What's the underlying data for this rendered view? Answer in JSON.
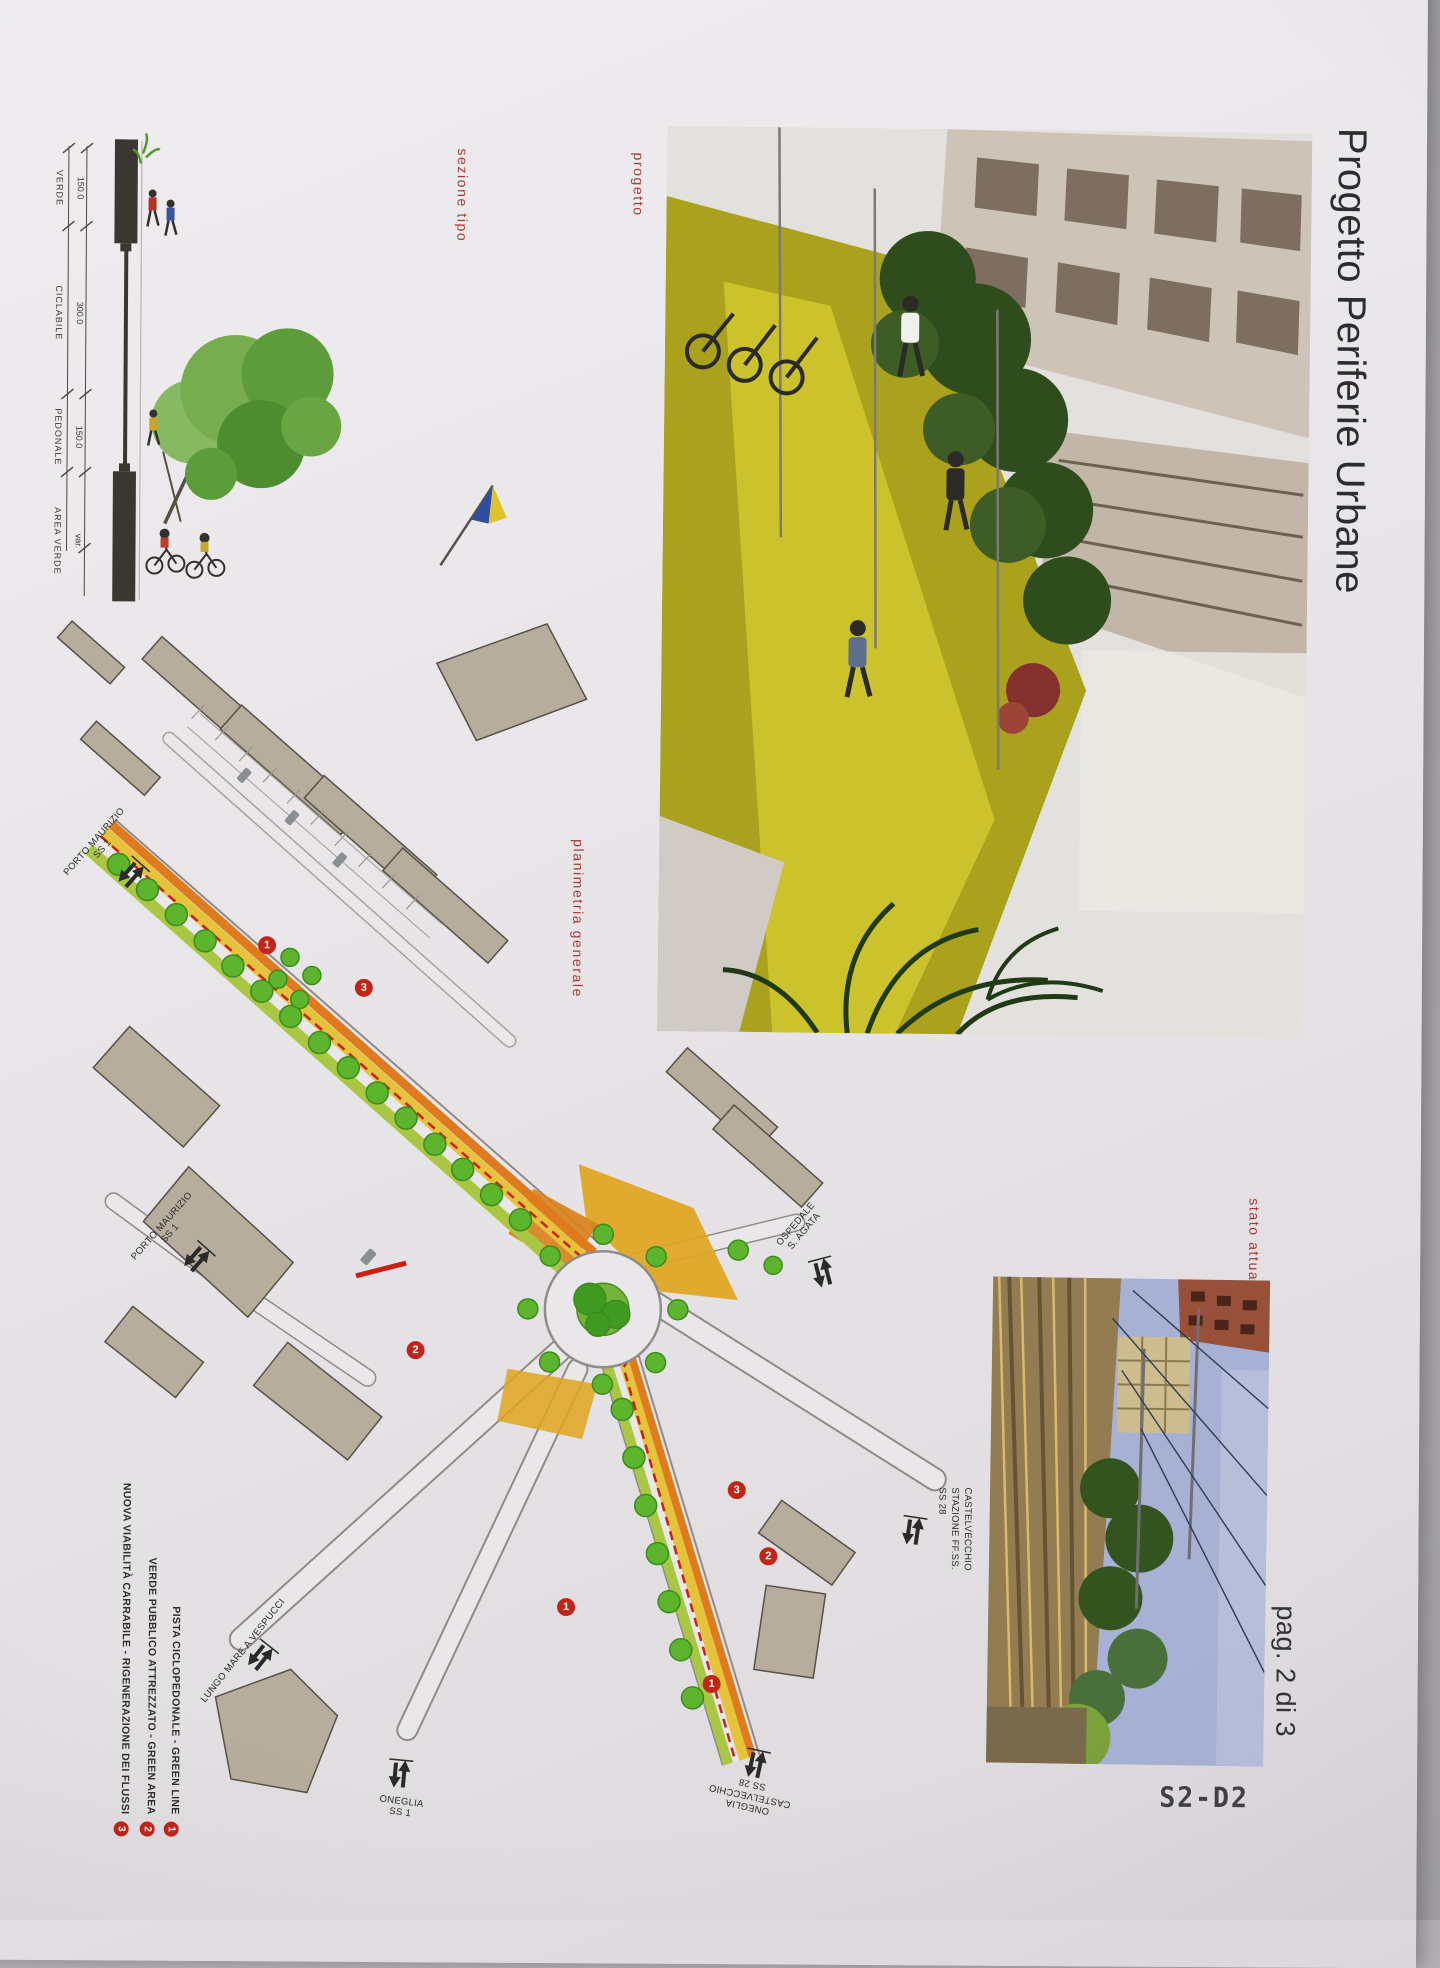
{
  "page": {
    "title": "Progetto Periferie Urbane",
    "page_label": "pag. 2 di 3",
    "sheet_code": "S2-D2"
  },
  "labels": {
    "sezione_tipo": "sezione tipo",
    "progetto": "progetto",
    "planimetria_generale": "planimetria generale",
    "stato_attuale": "stato attuale"
  },
  "section_diagram": {
    "dimensions": [
      {
        "value": "150.0",
        "name": "VERDE"
      },
      {
        "value": "300.0",
        "name": "CICLABILE"
      },
      {
        "value": "150.0",
        "name": "PEDONALE"
      },
      {
        "value": "var.",
        "name": "AREA VERDE"
      }
    ]
  },
  "legend": {
    "items": [
      {
        "n": "1",
        "text": "PISTA CICLOPEDONALE - GREEN LINE"
      },
      {
        "n": "2",
        "text": "VERDE PUBBLICO ATTREZZATO - GREEN AREA"
      },
      {
        "n": "3",
        "text": "NUOVA VIABILITÀ CARRABILE - RIGENERAZIONE DEI FLUSSI"
      }
    ]
  },
  "plan": {
    "labels": [
      {
        "id": "porto-maurizio-nord",
        "lines": [
          "PORTO MAURIZIO",
          "SS 1"
        ]
      },
      {
        "id": "porto-maurizio",
        "lines": [
          "PORTO MAURIZIO",
          "SS 1"
        ]
      },
      {
        "id": "lungomare",
        "lines": [
          "LUNGO MARE A VESPUCCI"
        ]
      },
      {
        "id": "oneglia-ss1",
        "lines": [
          "ONEGLIA",
          "SS 1"
        ]
      },
      {
        "id": "oneglia-castelvecchio",
        "lines": [
          "ONEGLIA",
          "CASTELVECCHIO",
          "SS 28"
        ]
      },
      {
        "id": "ospedale",
        "lines": [
          "OSPEDALE",
          "S. AGATA"
        ]
      },
      {
        "id": "stazione",
        "lines": [
          "SS 28",
          "STAZIONE FF.SS.",
          "CASTELVECCHIO"
        ]
      }
    ],
    "markers": [
      {
        "n": "1"
      },
      {
        "n": "3"
      },
      {
        "n": "2"
      },
      {
        "n": "3"
      },
      {
        "n": "2"
      },
      {
        "n": "1"
      },
      {
        "n": "1"
      }
    ]
  },
  "colors": {
    "label_red": "#a63a31",
    "marker_red": "#c22418",
    "green_line": "#5cb52c",
    "road_orange": "#df7a1e",
    "road_yellow": "#e5c33a",
    "building_tan": "#b6ad9c"
  }
}
